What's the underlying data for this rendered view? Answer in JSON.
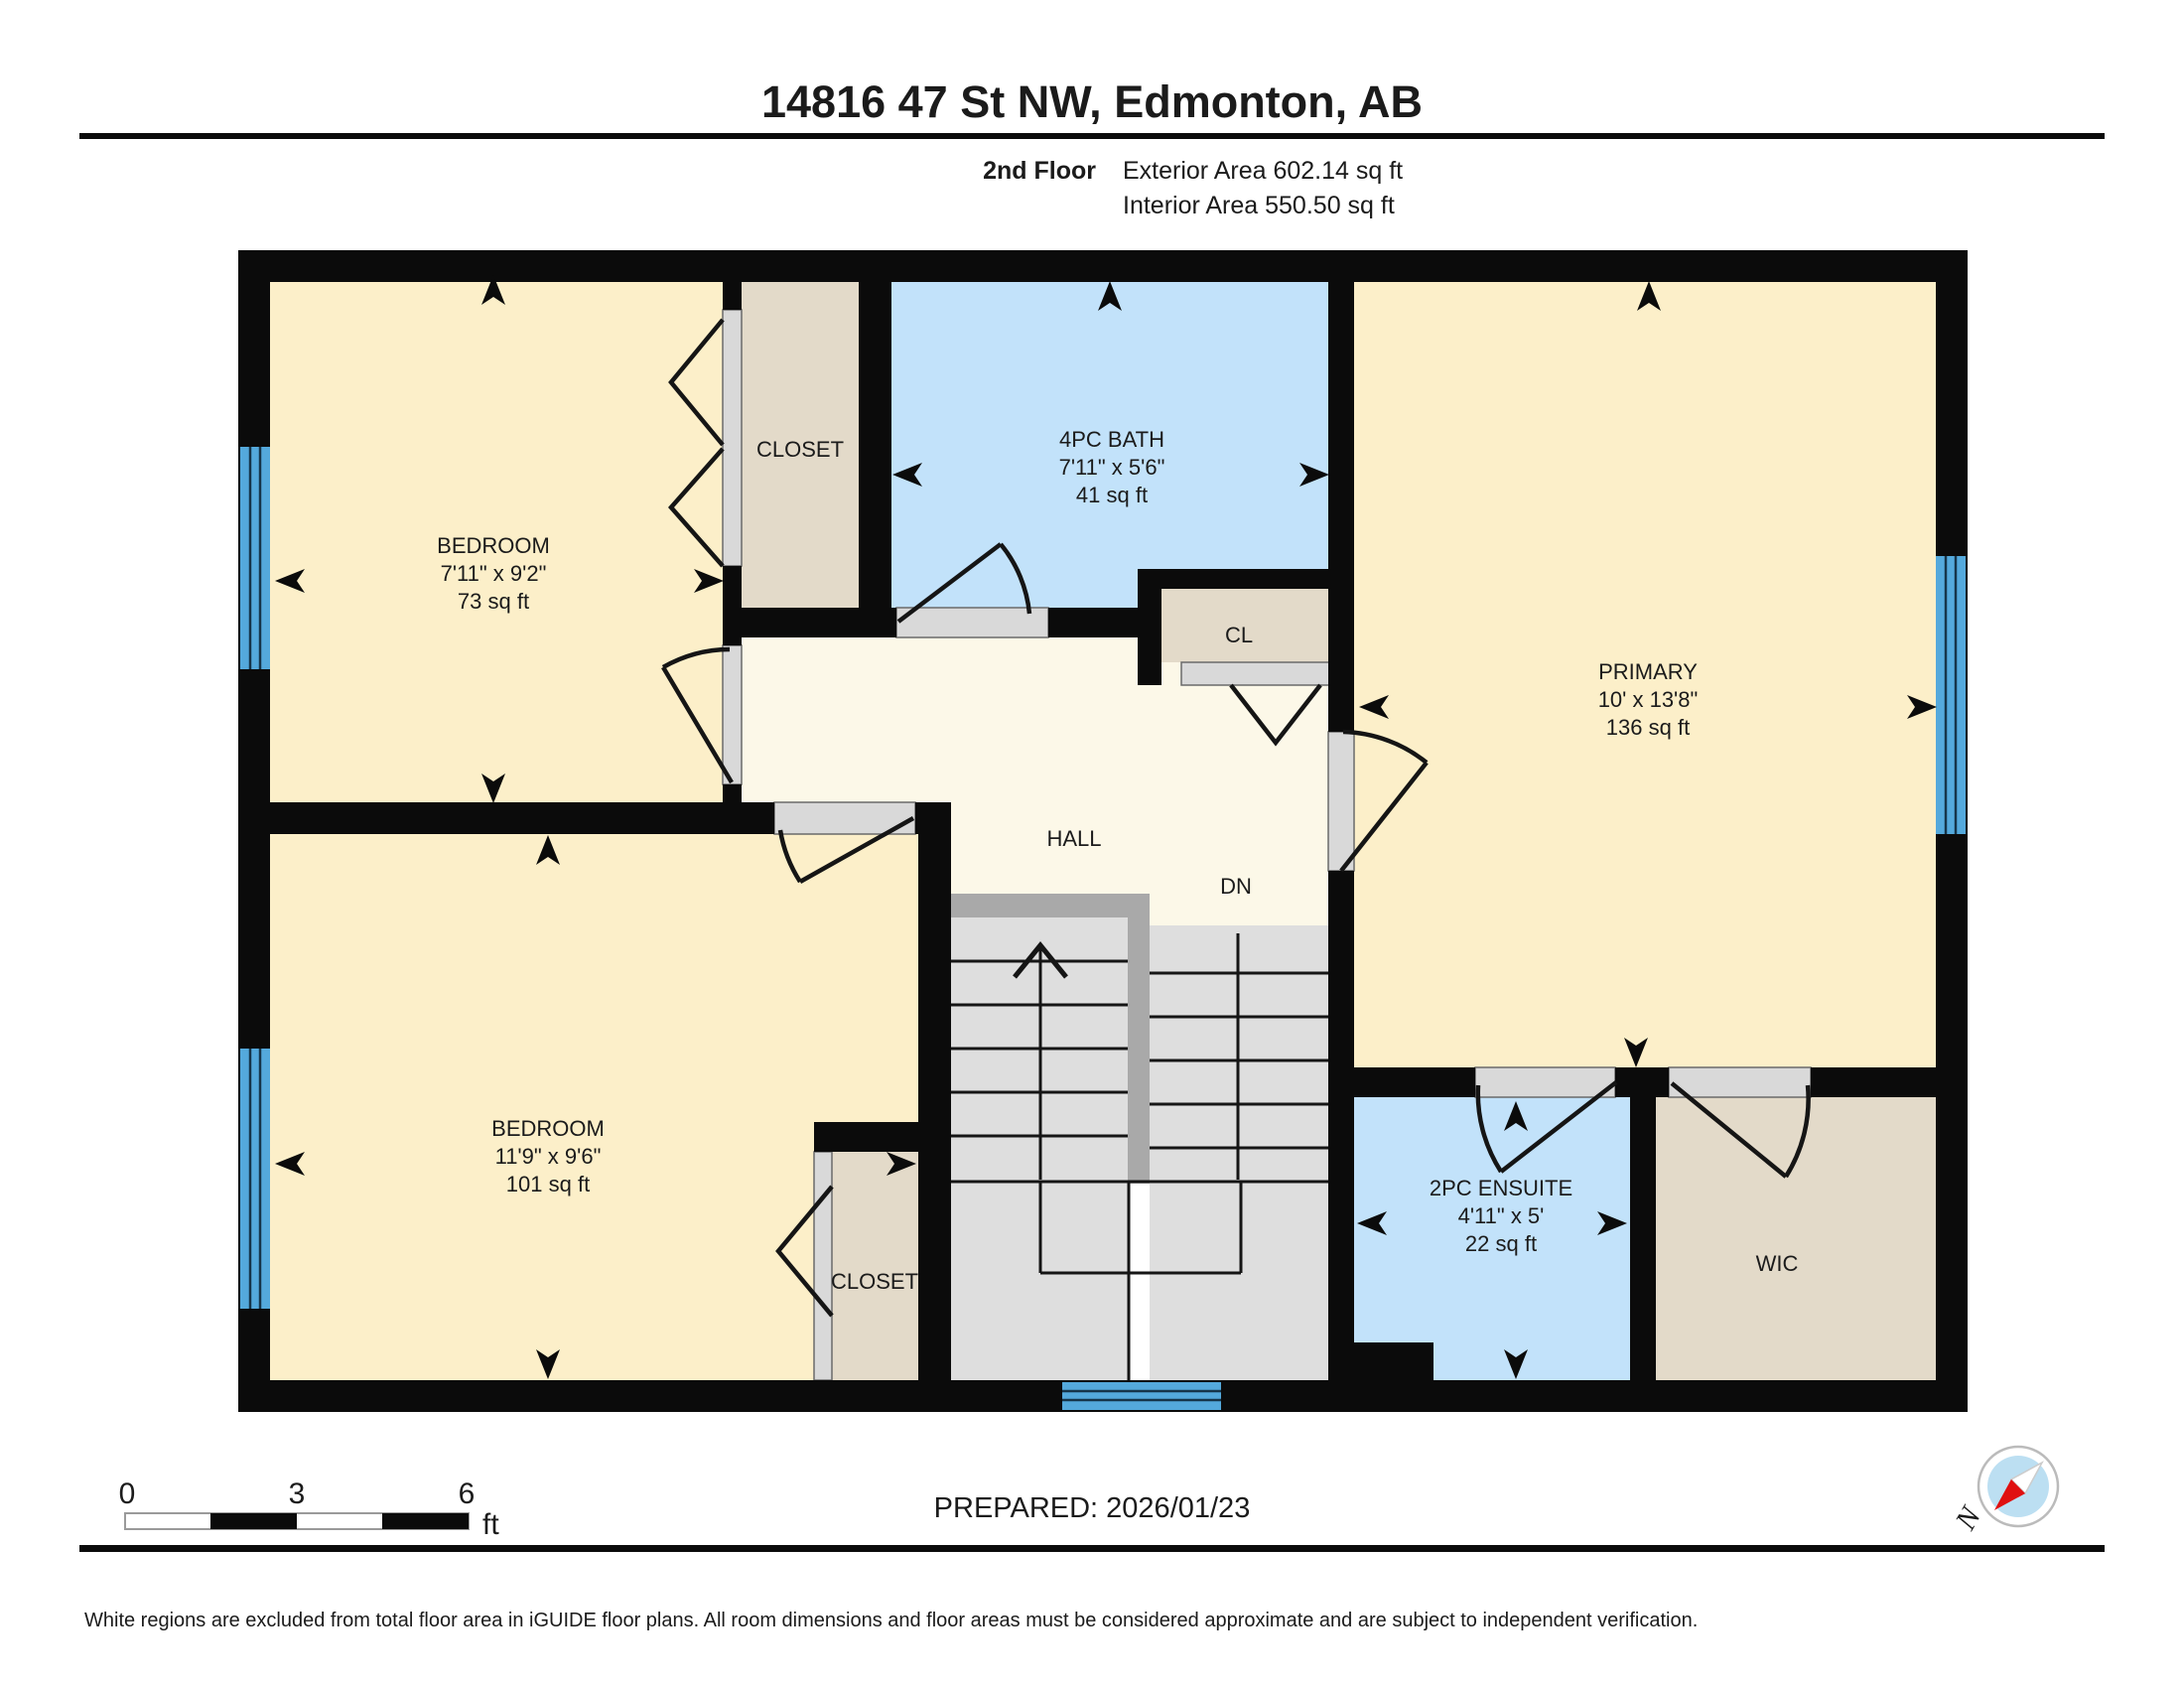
{
  "header": {
    "title": "14816 47 St NW, Edmonton, AB",
    "floor_label": "2nd Floor",
    "exterior_area": "Exterior Area 602.14 sq ft",
    "interior_area": "Interior Area 550.50 sq ft"
  },
  "rooms": {
    "bedroom_top": {
      "name": "BEDROOM",
      "dims": "7'11\" x 9'2\"",
      "area": "73 sq ft"
    },
    "closet_top": {
      "name": "CLOSET"
    },
    "bath": {
      "name": "4PC BATH",
      "dims": "7'11\" x 5'6\"",
      "area": "41 sq ft"
    },
    "primary": {
      "name": "PRIMARY",
      "dims": "10' x 13'8\"",
      "area": "136 sq ft"
    },
    "closet_cl": {
      "name": "CL"
    },
    "hall": {
      "name": "HALL"
    },
    "bedroom_bottom": {
      "name": "BEDROOM",
      "dims": "11'9\" x 9'6\"",
      "area": "101 sq ft"
    },
    "closet_bottom": {
      "name": "CLOSET"
    },
    "ensuite": {
      "name": "2PC ENSUITE",
      "dims": "4'11\" x 5'",
      "area": "22 sq ft"
    },
    "wic": {
      "name": "WIC"
    }
  },
  "stairs": {
    "down_label": "DN"
  },
  "scale_bar": {
    "tick_0": "0",
    "tick_3": "3",
    "tick_6": "6",
    "unit": "ft"
  },
  "footer": {
    "prepared": "PREPARED: 2026/01/23",
    "disclaimer": "White regions are excluded from total floor area in iGUIDE floor plans. All room dimensions and floor areas must be considered approximate and are subject to independent verification.",
    "compass_north": "N"
  },
  "colors": {
    "room_yellow": "#FCEFC9",
    "hall_cream": "#FCF8E8",
    "wet_blue": "#C2E2FA",
    "closet_tan": "#E3DAC9",
    "window_blue": "#54A9DC",
    "stair_gray": "#DEDEDE",
    "stair_rail": "#A9A9A9",
    "door_gray": "#D9D9D9",
    "wall_black": "#0B0B0B",
    "compass_red": "#E01010"
  }
}
